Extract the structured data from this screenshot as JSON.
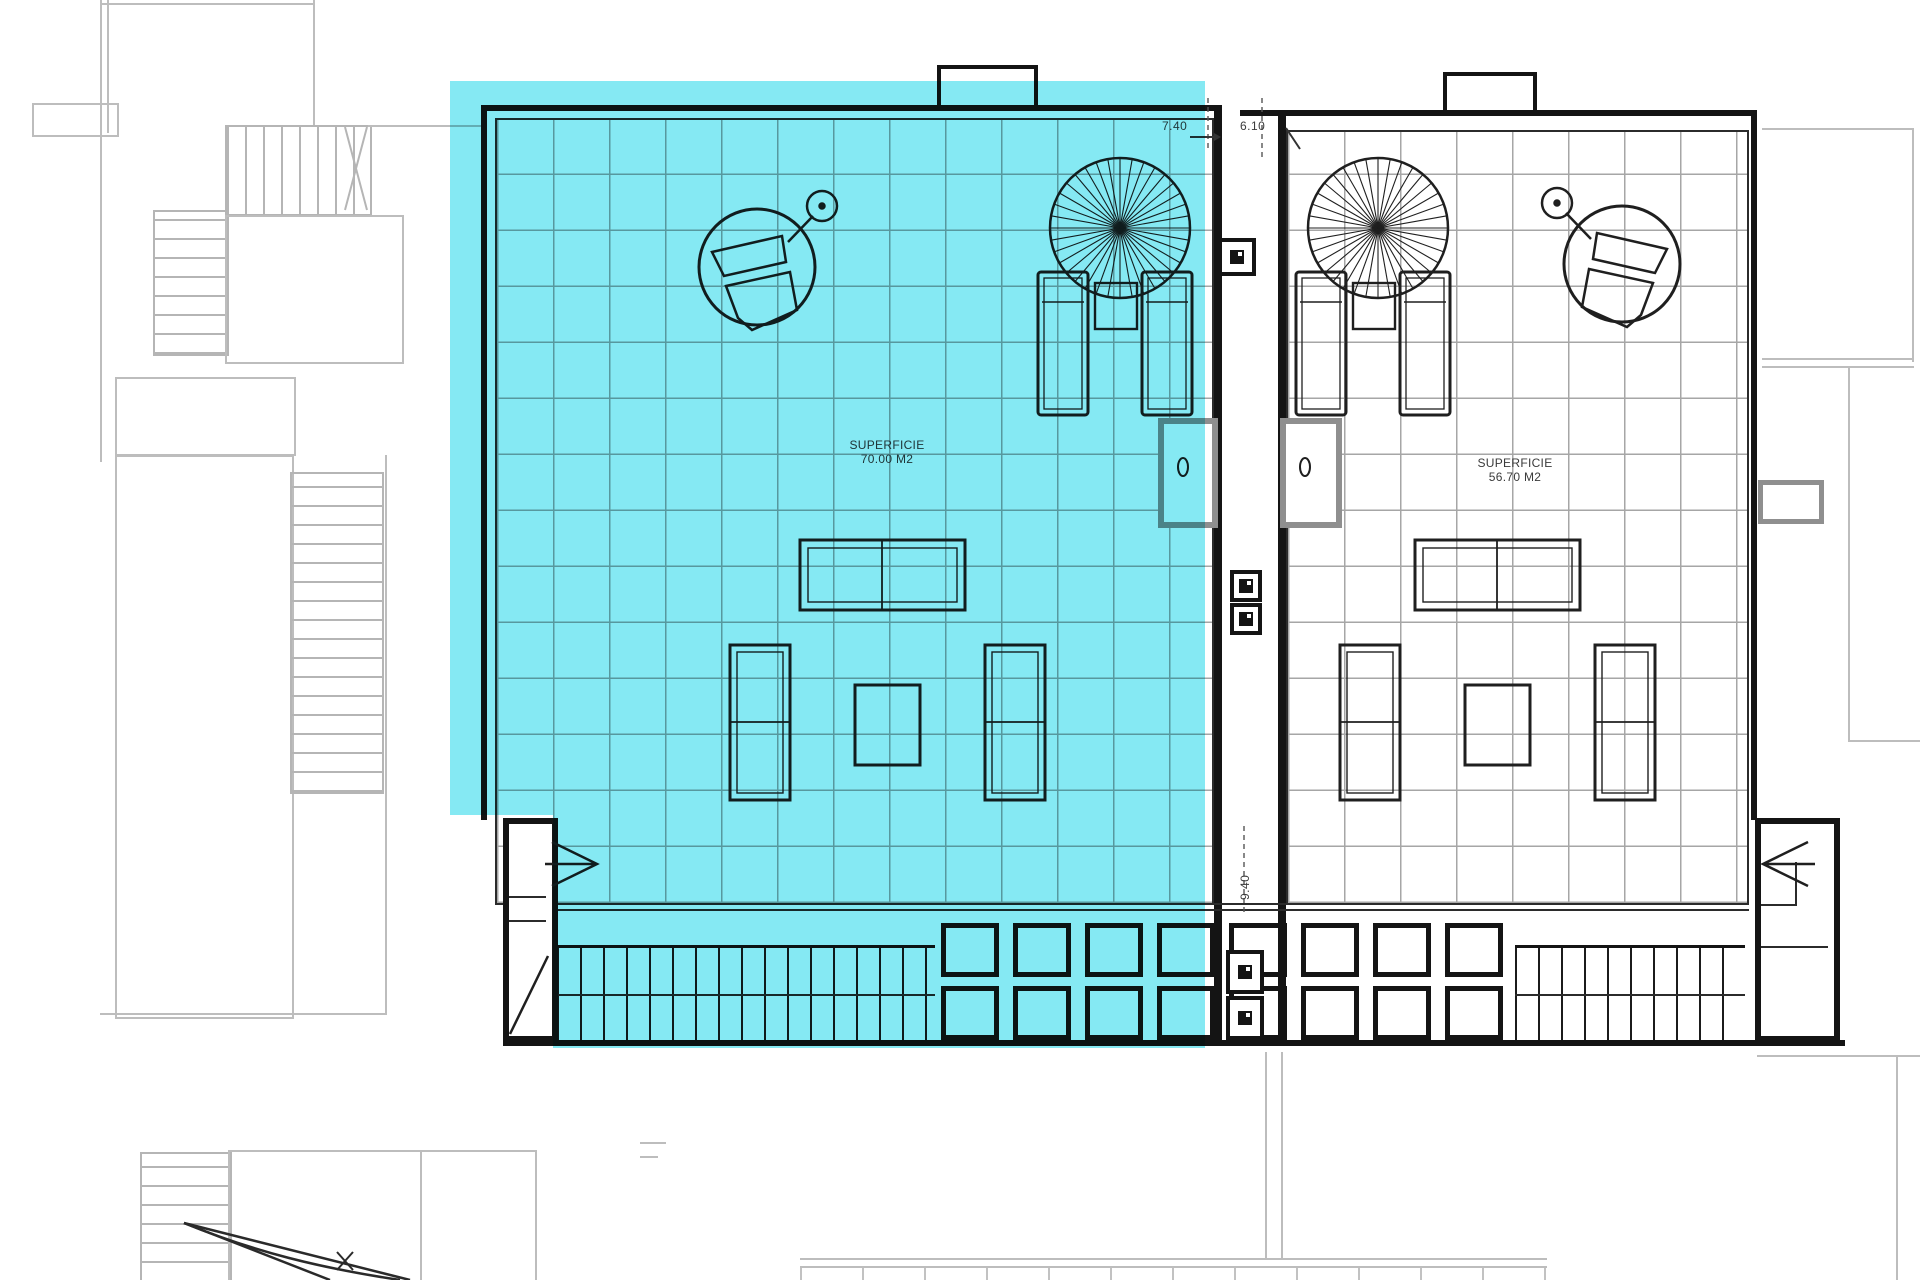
{
  "plan": {
    "type": "roof-terrace floor plan",
    "highlight_color": "#85e9f3",
    "left_terrace": {
      "highlighted": true,
      "area_label_line1": "SUPERFICIE",
      "area_label_line2": "70.00 M2",
      "width_dim": "7.40",
      "depth_dim": "9.40"
    },
    "right_terrace": {
      "highlighted": false,
      "area_label_line1": "SUPERFICIE",
      "area_label_line2": "56.70 M2",
      "width_dim": "6.10"
    }
  }
}
